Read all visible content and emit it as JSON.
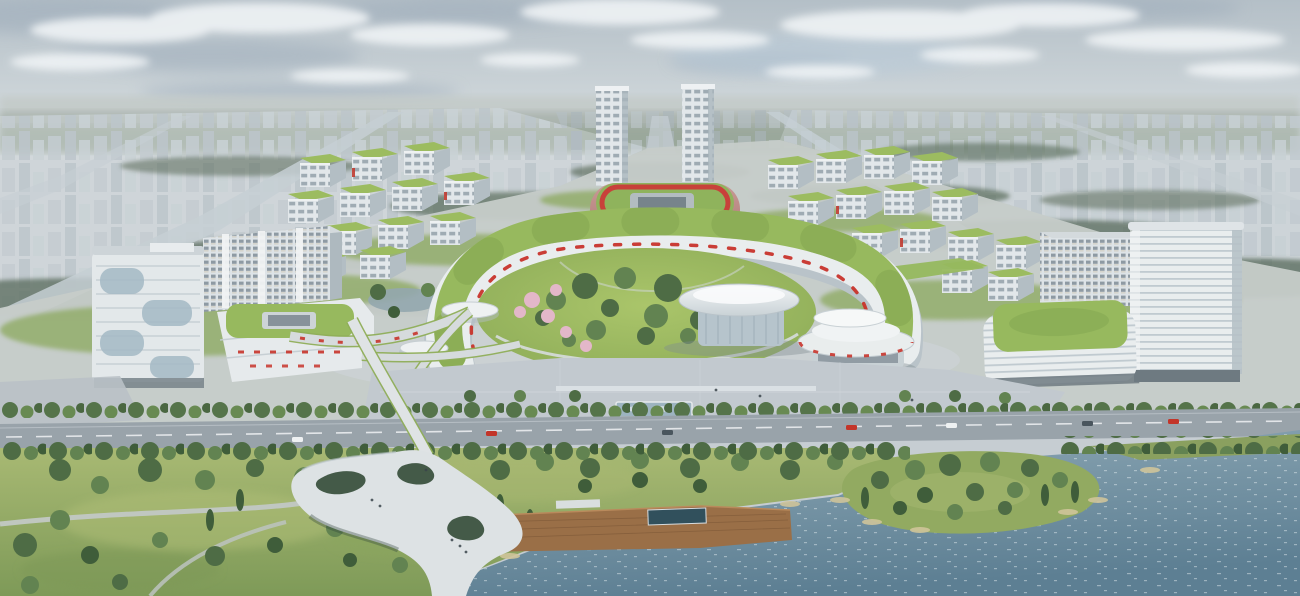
{
  "image": {
    "description": "Aerial architectural rendering of a riverside innovation campus: a horseshoe-shaped terraced building with a continuous green roof wraps a circular central park; a white saucer-roofed hall and a stacked-disc pavilion sit beside the park; twin high-rise towers and a rose-colored oval stadium with a rooftop running track stand behind; grids of white office blocks with planted roofs flank both sides; a tree-lined boulevard, paved plaza with reflecting pool, riverside lawn park, sculptural white pedestrian bridge, wooden boardwalk and a sparkling river occupy the foreground; a hazy low-rise city extends to the horizon under a pale cloudy sky."
  },
  "scene": {
    "objects": [
      "sky-with-clouds",
      "horizon-haze",
      "distant-city-left",
      "distant-city-right",
      "distant-boulevards",
      "campus-ground",
      "twin-tower-left",
      "twin-tower-right",
      "stadium-with-rooftop-track",
      "office-grid-left",
      "office-grid-right",
      "hospital-slab-left",
      "curved-glass-tower-left",
      "podium-green-ring-roof-left",
      "ribbon-tower-right",
      "podium-green-roof-right",
      "horseshoe-terrace-building",
      "central-circular-park",
      "blossom-trees",
      "saucer-hall",
      "stacked-disc-pavilion",
      "round-pavilions",
      "elevated-walkways",
      "waterfront-plaza",
      "reflecting-pool",
      "boulevard-road",
      "cars",
      "riverside-park",
      "park-paths",
      "sculptural-pedestrian-bridge",
      "wooden-boardwalk",
      "river",
      "river-island",
      "reed-beds"
    ]
  },
  "palette": {
    "sky_top": "#b4bfc7",
    "sky_light": "#ccd4d8",
    "horizon_haze": "#c3cac8",
    "distant_city": "#b0bac0",
    "distant_trees": "#5f7161",
    "building_white": "#e9edee",
    "building_shade": "#b2bdc3",
    "glass_blue": "#a3b8c4",
    "green_roof": "#97b95e",
    "stadium_rose": "#c08e8b",
    "stadium_roof_green": "#8fb35c",
    "stadium_track_red": "#c8413a",
    "accent_red": "#c8342b",
    "lawn_bright": "#aac56a",
    "lawn": "#8cab57",
    "grass_light": "#a8b973",
    "grass_dark": "#7e9a58",
    "tree_dark": "#46633d",
    "tree_mid": "#5d7d49",
    "tree_light": "#739552",
    "blossom_pink": "#e3b7c9",
    "road": "#99a3aa",
    "plaza": "#c2c9cf",
    "walkway": "#d6dbdd",
    "bridge_white": "#dde2e4",
    "wood_deck": "#9a6f47",
    "water_light": "#8fa9b6",
    "water_deep": "#5d7f93",
    "reed_tan": "#cfc49a"
  }
}
